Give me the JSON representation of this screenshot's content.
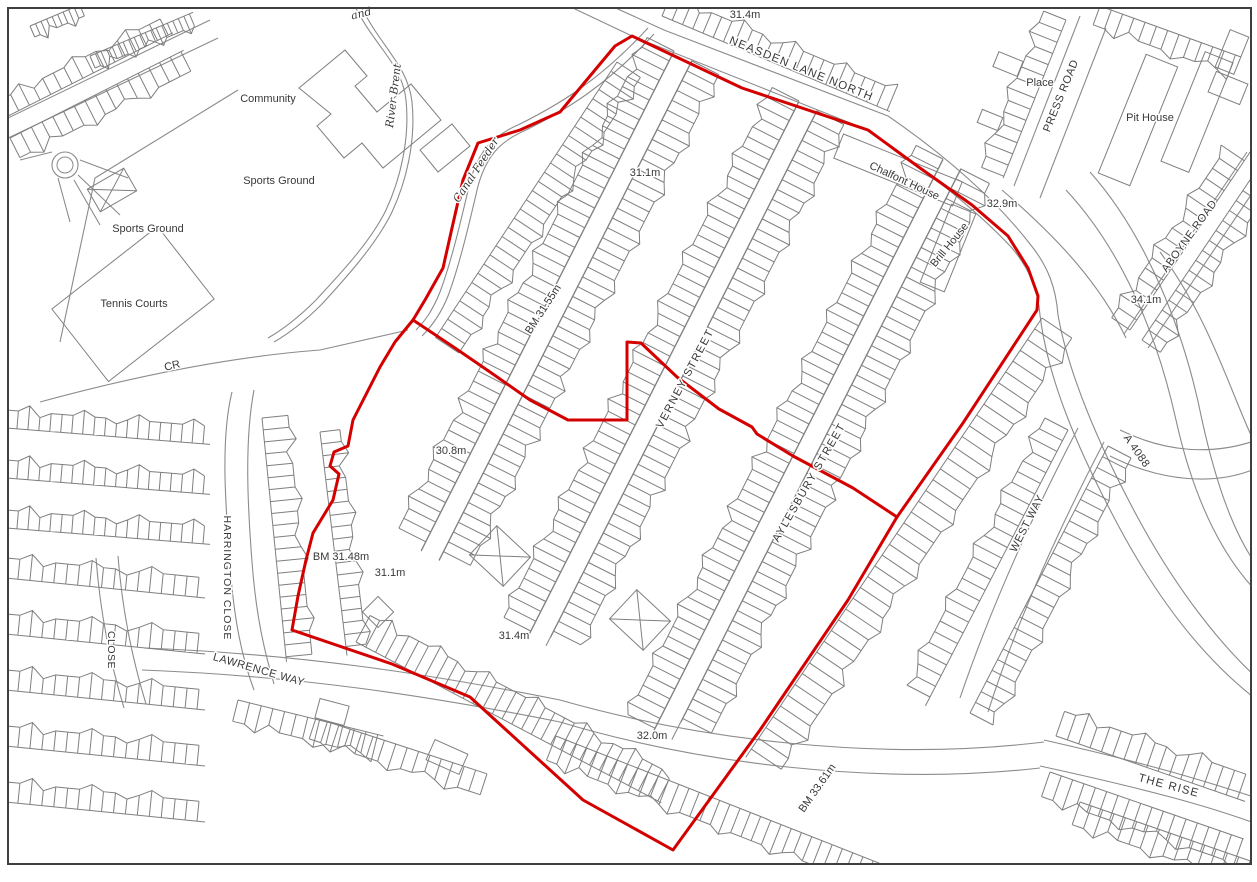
{
  "map": {
    "background": "#ffffff",
    "frame_color": "#3f3f3f",
    "line_color": "#8b8b8b",
    "boundary_color": "#d40000",
    "label_color": "#383838",
    "street_names": [
      {
        "text": "NEASDEN LANE NORTH",
        "x": 800,
        "y": 72,
        "rot": 22,
        "size": 11.5,
        "ls": 1.2
      },
      {
        "text": "PRESS ROAD",
        "x": 1064,
        "y": 97,
        "rot": -68,
        "size": 11,
        "ls": 0.5
      },
      {
        "text": "ABOYNE ROAD",
        "x": 1192,
        "y": 238,
        "rot": -54,
        "size": 11,
        "ls": 0.5
      },
      {
        "text": "VERNEY STREET",
        "x": 688,
        "y": 380,
        "rot": -62,
        "size": 11,
        "ls": 1.5
      },
      {
        "text": "AYLESBURY STREET",
        "x": 812,
        "y": 484,
        "rot": -60,
        "size": 11,
        "ls": 1.5
      },
      {
        "text": "WEST WAY",
        "x": 1030,
        "y": 525,
        "rot": -63,
        "size": 11,
        "ls": 0.5
      },
      {
        "text": "HARRINGTON CLOSE",
        "x": 224,
        "y": 578,
        "rot": 90,
        "size": 10.5,
        "ls": 1
      },
      {
        "text": "CLOSE",
        "x": 108,
        "y": 650,
        "rot": 90,
        "size": 10.5,
        "ls": 0.5
      },
      {
        "text": "LAWRENCE WAY",
        "x": 258,
        "y": 673,
        "rot": 16,
        "size": 11,
        "ls": 0.5
      },
      {
        "text": "THE RISE",
        "x": 1168,
        "y": 789,
        "rot": 15,
        "size": 11.5,
        "ls": 1.2
      },
      {
        "text": "A 4088",
        "x": 1134,
        "y": 453,
        "rot": 55,
        "size": 11,
        "ls": 0.5
      }
    ],
    "place_names": [
      {
        "text": "and",
        "x": 362,
        "y": 17,
        "rot": -14,
        "size": 11,
        "italic": true
      },
      {
        "text": "Community",
        "x": 268,
        "y": 102,
        "rot": 0,
        "size": 11
      },
      {
        "text": "Sports Ground",
        "x": 279,
        "y": 184,
        "rot": 0,
        "size": 11
      },
      {
        "text": "Sports Ground",
        "x": 148,
        "y": 232,
        "rot": 0,
        "size": 11
      },
      {
        "text": "Tennis Courts",
        "x": 134,
        "y": 307,
        "rot": 0,
        "size": 11
      },
      {
        "text": "River Brent",
        "x": 397,
        "y": 96,
        "rot": -83,
        "size": 11,
        "italic": true
      },
      {
        "text": "Canal Feeder",
        "x": 479,
        "y": 172,
        "rot": -57,
        "size": 11,
        "italic": true
      },
      {
        "text": "CR",
        "x": 173,
        "y": 369,
        "rot": -14,
        "size": 11
      },
      {
        "text": "Place",
        "x": 1040,
        "y": 86,
        "rot": 0,
        "size": 11
      },
      {
        "text": "Pit House",
        "x": 1150,
        "y": 121,
        "rot": 0,
        "size": 11
      },
      {
        "text": "Chalfont House",
        "x": 903,
        "y": 184,
        "rot": 25,
        "size": 11
      },
      {
        "text": "Brill House",
        "x": 952,
        "y": 247,
        "rot": -51,
        "size": 11
      }
    ],
    "spot_heights": [
      {
        "text": "31.4m",
        "x": 745,
        "y": 18,
        "rot": 0,
        "size": 11
      },
      {
        "text": "31.1m",
        "x": 645,
        "y": 176,
        "rot": 0,
        "size": 11
      },
      {
        "text": "32.9m",
        "x": 1002,
        "y": 207,
        "rot": 0,
        "size": 11
      },
      {
        "text": "34.1m",
        "x": 1146,
        "y": 303,
        "rot": 0,
        "size": 11
      },
      {
        "text": "30.8m",
        "x": 451,
        "y": 454,
        "rot": 0,
        "size": 11
      },
      {
        "text": "31.1m",
        "x": 390,
        "y": 576,
        "rot": 0,
        "size": 11
      },
      {
        "text": "31.4m",
        "x": 514,
        "y": 639,
        "rot": 0,
        "size": 11
      },
      {
        "text": "32.0m",
        "x": 652,
        "y": 739,
        "rot": 0,
        "size": 11
      }
    ],
    "benchmarks": [
      {
        "text": "BM 31.55m",
        "x": 546,
        "y": 311,
        "rot": -57,
        "size": 11
      },
      {
        "text": "BM 31.48m",
        "x": 341,
        "y": 560,
        "rot": 0,
        "size": 11
      },
      {
        "text": "BM 33.61m",
        "x": 820,
        "y": 790,
        "rot": -55,
        "size": 11
      }
    ],
    "site_boundary": {
      "outer": [
        [
          632,
          36
        ],
        [
          742,
          88
        ],
        [
          868,
          130
        ],
        [
          920,
          168
        ],
        [
          972,
          205
        ],
        [
          1008,
          236
        ],
        [
          1028,
          268
        ],
        [
          1038,
          296
        ],
        [
          1037,
          310
        ],
        [
          963,
          423
        ],
        [
          897,
          517
        ],
        [
          848,
          600
        ],
        [
          760,
          730
        ],
        [
          673,
          850
        ],
        [
          583,
          800
        ],
        [
          470,
          697
        ],
        [
          392,
          664
        ],
        [
          292,
          630
        ],
        [
          298,
          596
        ],
        [
          306,
          560
        ],
        [
          313,
          533
        ],
        [
          333,
          500
        ],
        [
          339,
          474
        ],
        [
          330,
          466
        ],
        [
          334,
          452
        ],
        [
          348,
          446
        ],
        [
          353,
          420
        ],
        [
          380,
          367
        ],
        [
          395,
          342
        ],
        [
          413,
          320
        ],
        [
          425,
          300
        ],
        [
          443,
          268
        ],
        [
          452,
          228
        ],
        [
          463,
          180
        ],
        [
          478,
          143
        ],
        [
          520,
          130
        ],
        [
          560,
          112
        ],
        [
          615,
          46
        ]
      ],
      "divider": [
        [
          413,
          320
        ],
        [
          455,
          348
        ],
        [
          490,
          372
        ],
        [
          530,
          400
        ],
        [
          568,
          420
        ],
        [
          627,
          420
        ],
        [
          627,
          342
        ],
        [
          641,
          343
        ],
        [
          677,
          377
        ],
        [
          719,
          409
        ],
        [
          752,
          427
        ],
        [
          757,
          434
        ],
        [
          793,
          456
        ],
        [
          853,
          488
        ],
        [
          897,
          517
        ]
      ]
    }
  }
}
